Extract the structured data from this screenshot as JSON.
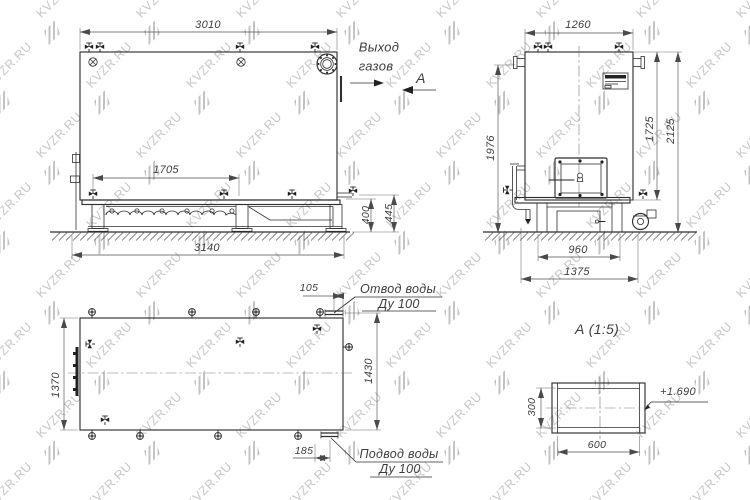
{
  "watermark": {
    "text": "KVZR.RU",
    "color": "#c7c7c7"
  },
  "side_view": {
    "dim_top_width": "3010",
    "dim_inner_length": "1705",
    "dim_base_width": "3140",
    "dim_base_height": "400",
    "dim_total_height": "445"
  },
  "front_view": {
    "dim_top_width": "1260",
    "dim_height_left": "1976",
    "dim_height_inner": "1725",
    "dim_height_total": "2125",
    "dim_base_inner": "960",
    "dim_base_total": "1375"
  },
  "plan_view": {
    "dim_width": "1370",
    "dim_outlet_offset": "105",
    "dim_inlet_offset": "185",
    "dim_right_span": "1430",
    "outlet_label_line1": "Отвод воды",
    "outlet_label_line2": "Ду 100",
    "inlet_label_line1": "Подвод воды",
    "inlet_label_line2": "Ду 100"
  },
  "detail_view": {
    "title": "А  (1:5)",
    "dim_height": "300",
    "dim_width": "600",
    "elevation_mark": "+1.690"
  },
  "annotations": {
    "gas_outlet_line1": "Выход",
    "gas_outlet_line2": "газов",
    "section_label": "А"
  }
}
